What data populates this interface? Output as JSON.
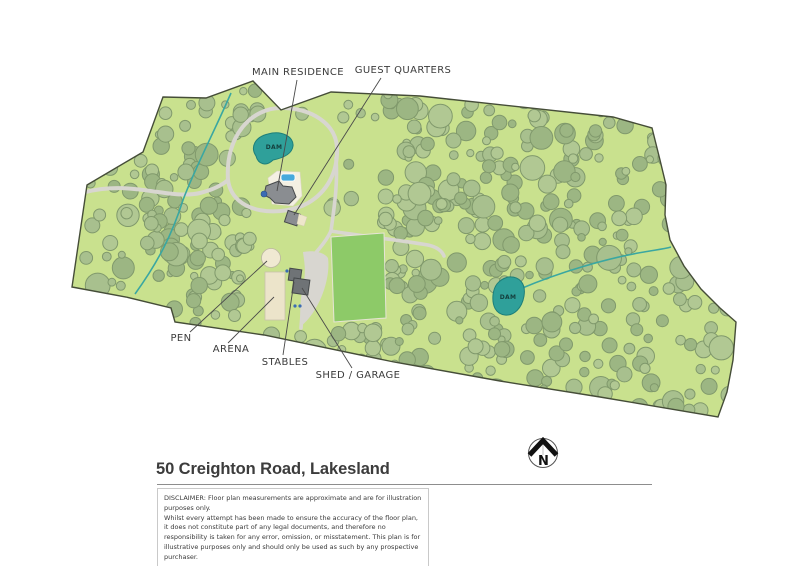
{
  "page": {
    "title": "50 Creighton Road, Lakesland"
  },
  "map": {
    "labels": {
      "main_residence": "MAIN RESIDENCE",
      "guest_quarters": "GUEST QUARTERS",
      "pen": "PEN",
      "arena": "ARENA",
      "stables": "STABLES",
      "shed_garage": "SHED / GARAGE",
      "dam_upper": "DAM",
      "dam_lower": "DAM"
    },
    "compass": {
      "letter": "N"
    }
  },
  "disclaimer": {
    "paragraph1": "DISCLAIMER: Floor plan measurements are approximate and are for illustration purposes only.",
    "paragraph2": "Whilst every attempt has been made to ensure the accuracy of the floor plan, it does not constitute part of any legal documents, and therefore no responsibility is taken for any error, omission, or misstatement. This plan is for illustrative purposes only and should only be used as such by any prospective purchaser."
  },
  "colors": {
    "land": "#c9e18e",
    "boundary": "#454d38",
    "tree_fill": "#a5bd8b",
    "tree_stroke": "#80996c",
    "road": "#d8d6d0",
    "creek": "#3aa7a1",
    "dam_fill": "#2fa09a",
    "dam_stroke": "#1d7f7a",
    "paddock": "#8dca68",
    "building_gray": "#8a8d91",
    "building_dark": "#6f7376",
    "cream": "#eee6cb",
    "pool_blue": "#46a9dc",
    "dot_blue": "#3b6cb4",
    "label_text": "#3b3b3b"
  }
}
